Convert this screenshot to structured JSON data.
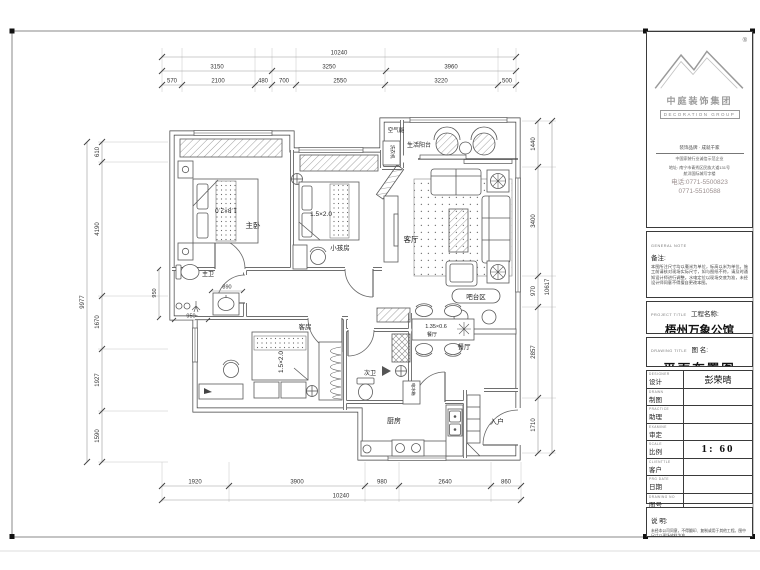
{
  "title_block": {
    "registered_mark": "®",
    "company_cn": "中庭装饰集团",
    "company_en": "DECORATION GROUP",
    "slogan_line1": "装饰品牌 · 成就千家",
    "slogan_line2": "中国家装行业诚信示范企业",
    "address_line1": "地址: 南宁市青秀区民族大道131号",
    "address_line2": "航洋国际城写字楼",
    "phone_line1": "电话:0771-5500823",
    "phone_line2": "0771-5510588",
    "general_note_en": "GENERAL NOTE",
    "general_note_cn": "备注:",
    "general_note_body": "本图所注尺寸均以毫米为单位，标高以米为单位。施工前请核对现场实际尺寸，如与图纸不符，请及时通知设计师进行调整。水电定位以现场交底为准，未经设计师同意不得擅自更改本图。",
    "project_en": "PROJECT TITLE",
    "project_cn": "工程名称:",
    "project_value": "梧州万象公馆",
    "drawing_en": "DRAWING TITLE",
    "drawing_cn": "图  名:",
    "drawing_value": "平面布置图",
    "rows": [
      {
        "en": "DESIGNER",
        "cn": "设计",
        "value": "彭荣晴"
      },
      {
        "en": "DRAWN",
        "cn": "制图",
        "value": ""
      },
      {
        "en": "PRACTICE",
        "cn": "助理",
        "value": ""
      },
      {
        "en": "EXAMINE",
        "cn": "审定",
        "value": ""
      },
      {
        "en": "SCALE",
        "cn": "比例",
        "value": "1: 60"
      },
      {
        "en": "CLIENTTLE",
        "cn": "客户",
        "value": ""
      },
      {
        "en": "PRG DATE",
        "cn": "日期",
        "value": ""
      },
      {
        "en": "DRAWING NO",
        "cn": "图号",
        "value": ""
      }
    ],
    "statement_cn": "说  明:",
    "statement_body": "未经本公司同意，不得翻印、复制或用于其他工程。图中尺寸以现场放样为准。"
  },
  "plan": {
    "rooms": {
      "master": "主卧",
      "master_bath": "主卫",
      "kids": "小孩房",
      "living": "客厅",
      "balcony": "生活阳台",
      "air_unit": "空气能",
      "washer": "洗衣机",
      "bar": "吧台区",
      "dining": "餐厅",
      "dining_inner": "餐厅",
      "guest": "客房",
      "second_bath": "次卫",
      "kitchen": "厨房",
      "entry": "入户",
      "fridge": "电冰箱"
    },
    "furniture": {
      "master_bed": "1.8×2.0",
      "kids_bed": "1.5×2.0",
      "guest_bed": "1.5×2.0",
      "dining_table": "1.35×0.6"
    }
  },
  "dims": {
    "top_total": "10240",
    "top_mid": [
      "3150",
      "3250",
      "3960"
    ],
    "top_inner": [
      "570",
      "2100",
      "480",
      "700",
      "2550",
      "3220",
      "500"
    ],
    "bottom_inner": [
      "1920",
      "3900",
      "980",
      "2640",
      "860"
    ],
    "bottom_total": "10240",
    "left_total": "9977",
    "left_inner": [
      "610",
      "4190",
      "1670",
      "1927",
      "1590"
    ],
    "right_total": "10617",
    "right_inner": [
      "1440",
      "3400",
      "970",
      "2857",
      "1710"
    ],
    "bath_sink": "890",
    "bath_width": "950",
    "bath_height": "950"
  }
}
